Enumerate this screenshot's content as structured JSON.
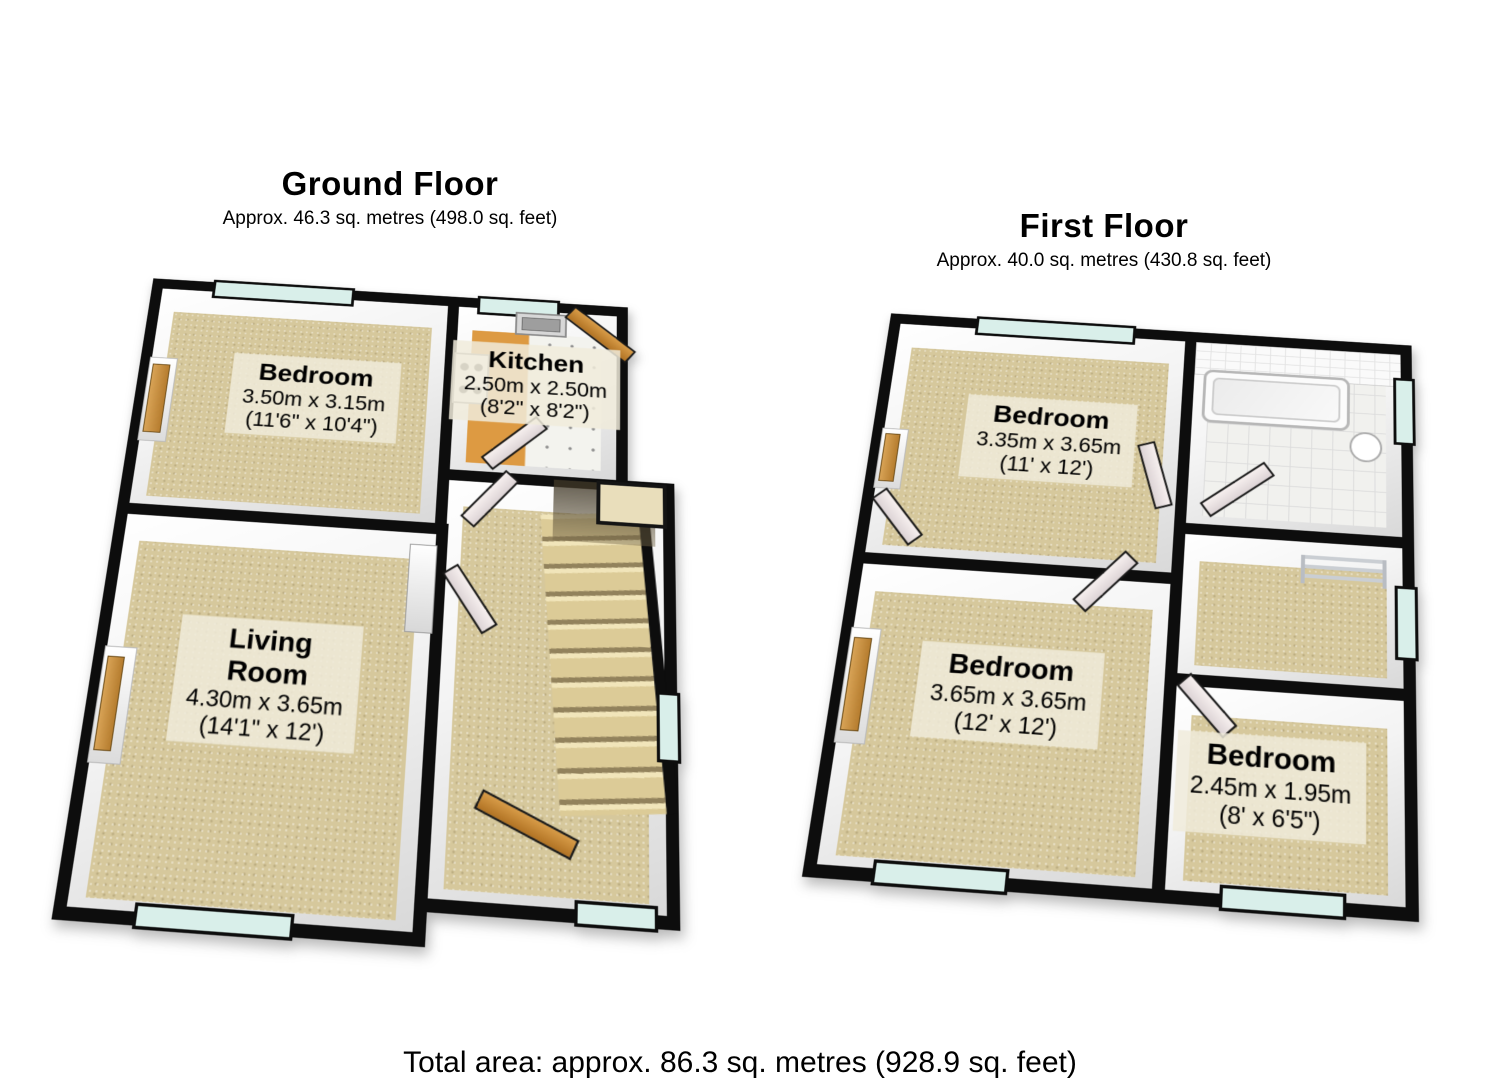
{
  "ground_floor": {
    "title": "Ground Floor",
    "subtitle": "Approx. 46.3 sq. metres (498.0 sq. feet)",
    "rooms": {
      "bedroom": {
        "name": "Bedroom",
        "metric": "3.50m x 3.15m",
        "imperial": "(11'6\" x 10'4\")"
      },
      "kitchen": {
        "name": "Kitchen",
        "metric": "2.50m x 2.50m",
        "imperial": "(8'2\" x 8'2\")"
      },
      "living_room": {
        "name": "Living Room",
        "metric": "4.30m x 3.65m",
        "imperial": "(14'1\" x 12')"
      }
    }
  },
  "first_floor": {
    "title": "First Floor",
    "subtitle": "Approx. 40.0 sq. metres (430.8 sq. feet)",
    "rooms": {
      "bedroom_1": {
        "name": "Bedroom",
        "metric": "3.35m x 3.65m",
        "imperial": "(11' x 12')"
      },
      "bedroom_2": {
        "name": "Bedroom",
        "metric": "3.65m x 3.65m",
        "imperial": "(12' x 12')"
      },
      "bedroom_3": {
        "name": "Bedroom",
        "metric": "2.45m x 1.95m",
        "imperial": "(8' x 6'5\")"
      }
    }
  },
  "footer": {
    "total_area": "Total area: approx. 86.3 sq. metres (928.9 sq. feet)"
  },
  "colors": {
    "wall": "#0d0d0d",
    "carpet": "#d6c89c",
    "kitchen_orange": "#dd9a42",
    "window_glass": "#d9efea",
    "label_background": "rgba(240,235,219,0.85)"
  }
}
